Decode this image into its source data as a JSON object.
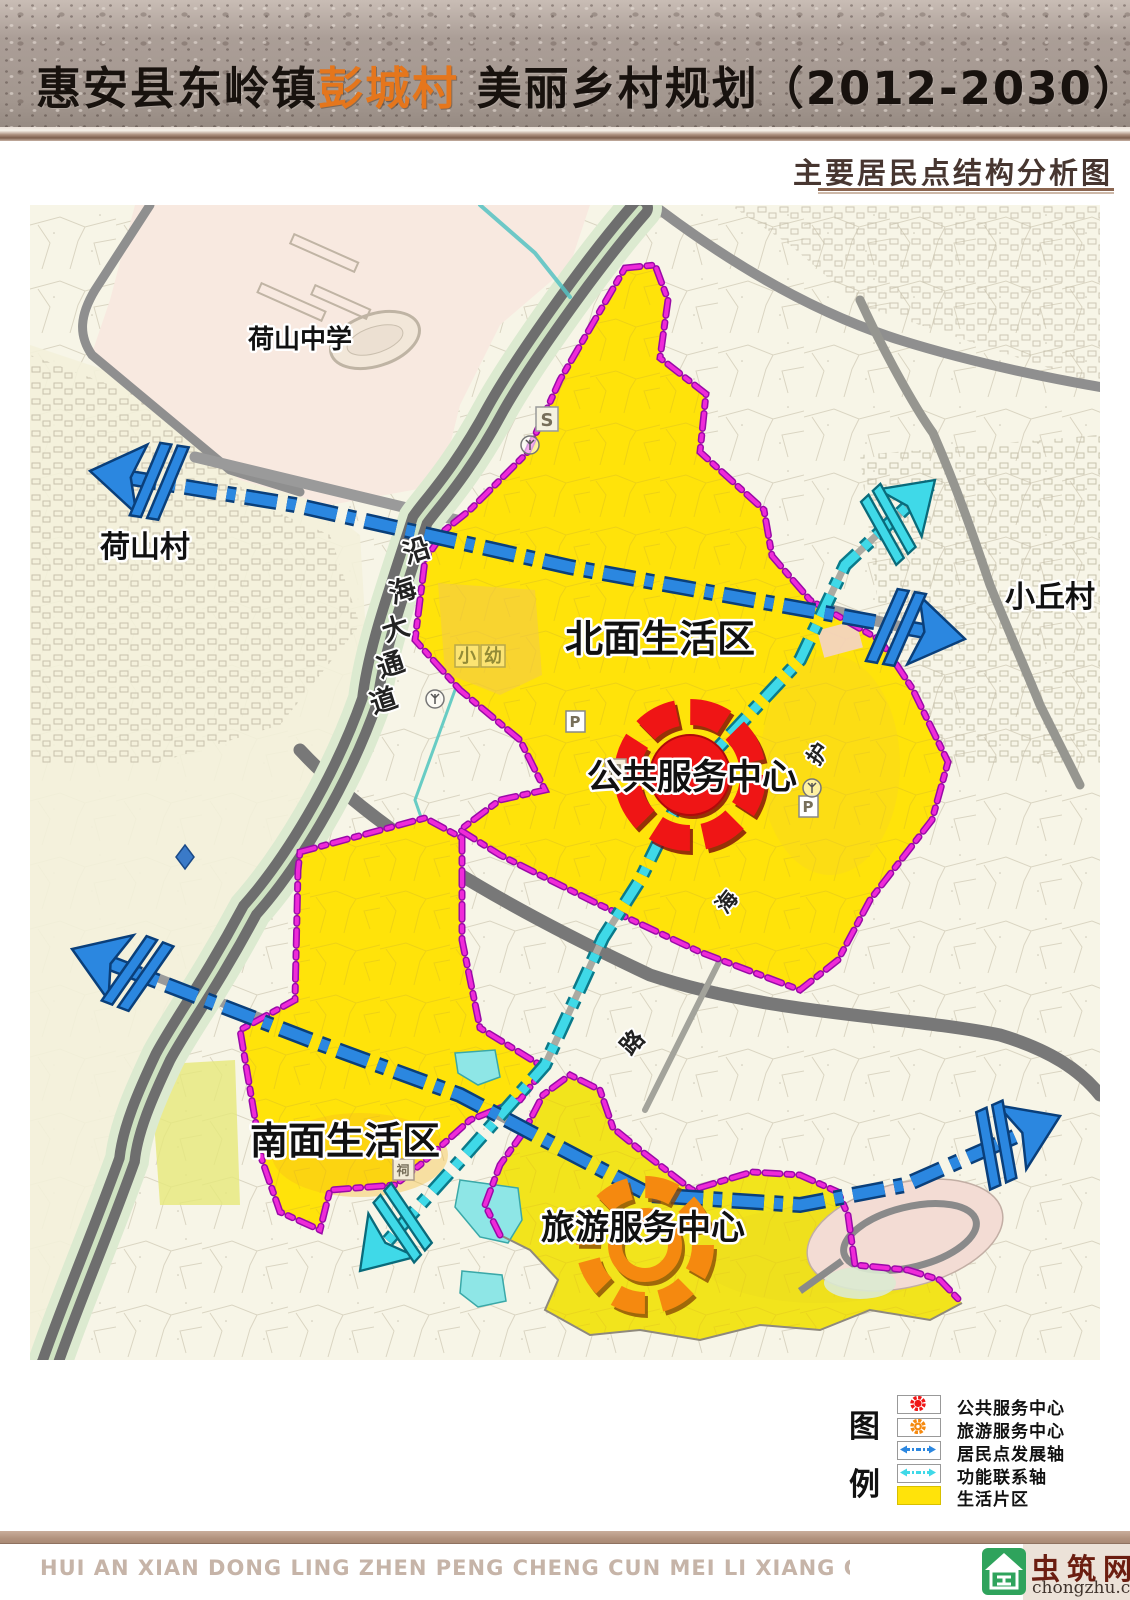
{
  "header": {
    "title_prefix": "惠安县东岭镇",
    "title_highlight": "彭城村",
    "title_suffix": " 美丽乡村规划（2012-2030）",
    "subtitle": "主要居民点结构分析图"
  },
  "map": {
    "labels": {
      "heshan_school": "荷山中学",
      "heshan_village": "荷山村",
      "xiaoqiu_village": "小丘村",
      "north_zone": "北面生活区",
      "south_zone": "南面生活区",
      "public_center": "公共服务中心",
      "tourism_center": "旅游服务中心"
    },
    "yanhai_chars": [
      "沿",
      "海",
      "大",
      "通",
      "道"
    ],
    "huhai_chars": [
      "护",
      "海",
      "路"
    ],
    "poi": {
      "s_marker": "S",
      "parking": "P",
      "ancestral_hall": "祠",
      "kindergarten_chars": [
        "小",
        "幼"
      ]
    }
  },
  "legend": {
    "title_chars": [
      "图",
      "例"
    ],
    "items": [
      {
        "label": "公共服务中心",
        "type": "public-service-center"
      },
      {
        "label": "旅游服务中心",
        "type": "tourism-service-center"
      },
      {
        "label": "居民点发展轴",
        "type": "settlement-development-axis"
      },
      {
        "label": "功能联系轴",
        "type": "function-connection-axis"
      },
      {
        "label": "生活片区",
        "type": "living-area"
      }
    ]
  },
  "footer": {
    "pinyin": "HUI AN XIAN DONG LING ZHEN PENG CHENG CUN MEI LI XIANG CUN GUI HUA",
    "logo_name": "虫筑网",
    "logo_domain": "chongzhu.cn"
  },
  "colors": {
    "living_area_yellow": "#ffe30a",
    "boundary_magenta": "#ef2ad8",
    "development_axis_blue": "#2b87e0",
    "function_axis_cyan": "#3fd9e8",
    "public_center_red": "#ef1515",
    "tourism_center_orange": "#f5890f",
    "banner_mauve": "#a79a93",
    "footer_bar_brown": "#b2937e"
  }
}
